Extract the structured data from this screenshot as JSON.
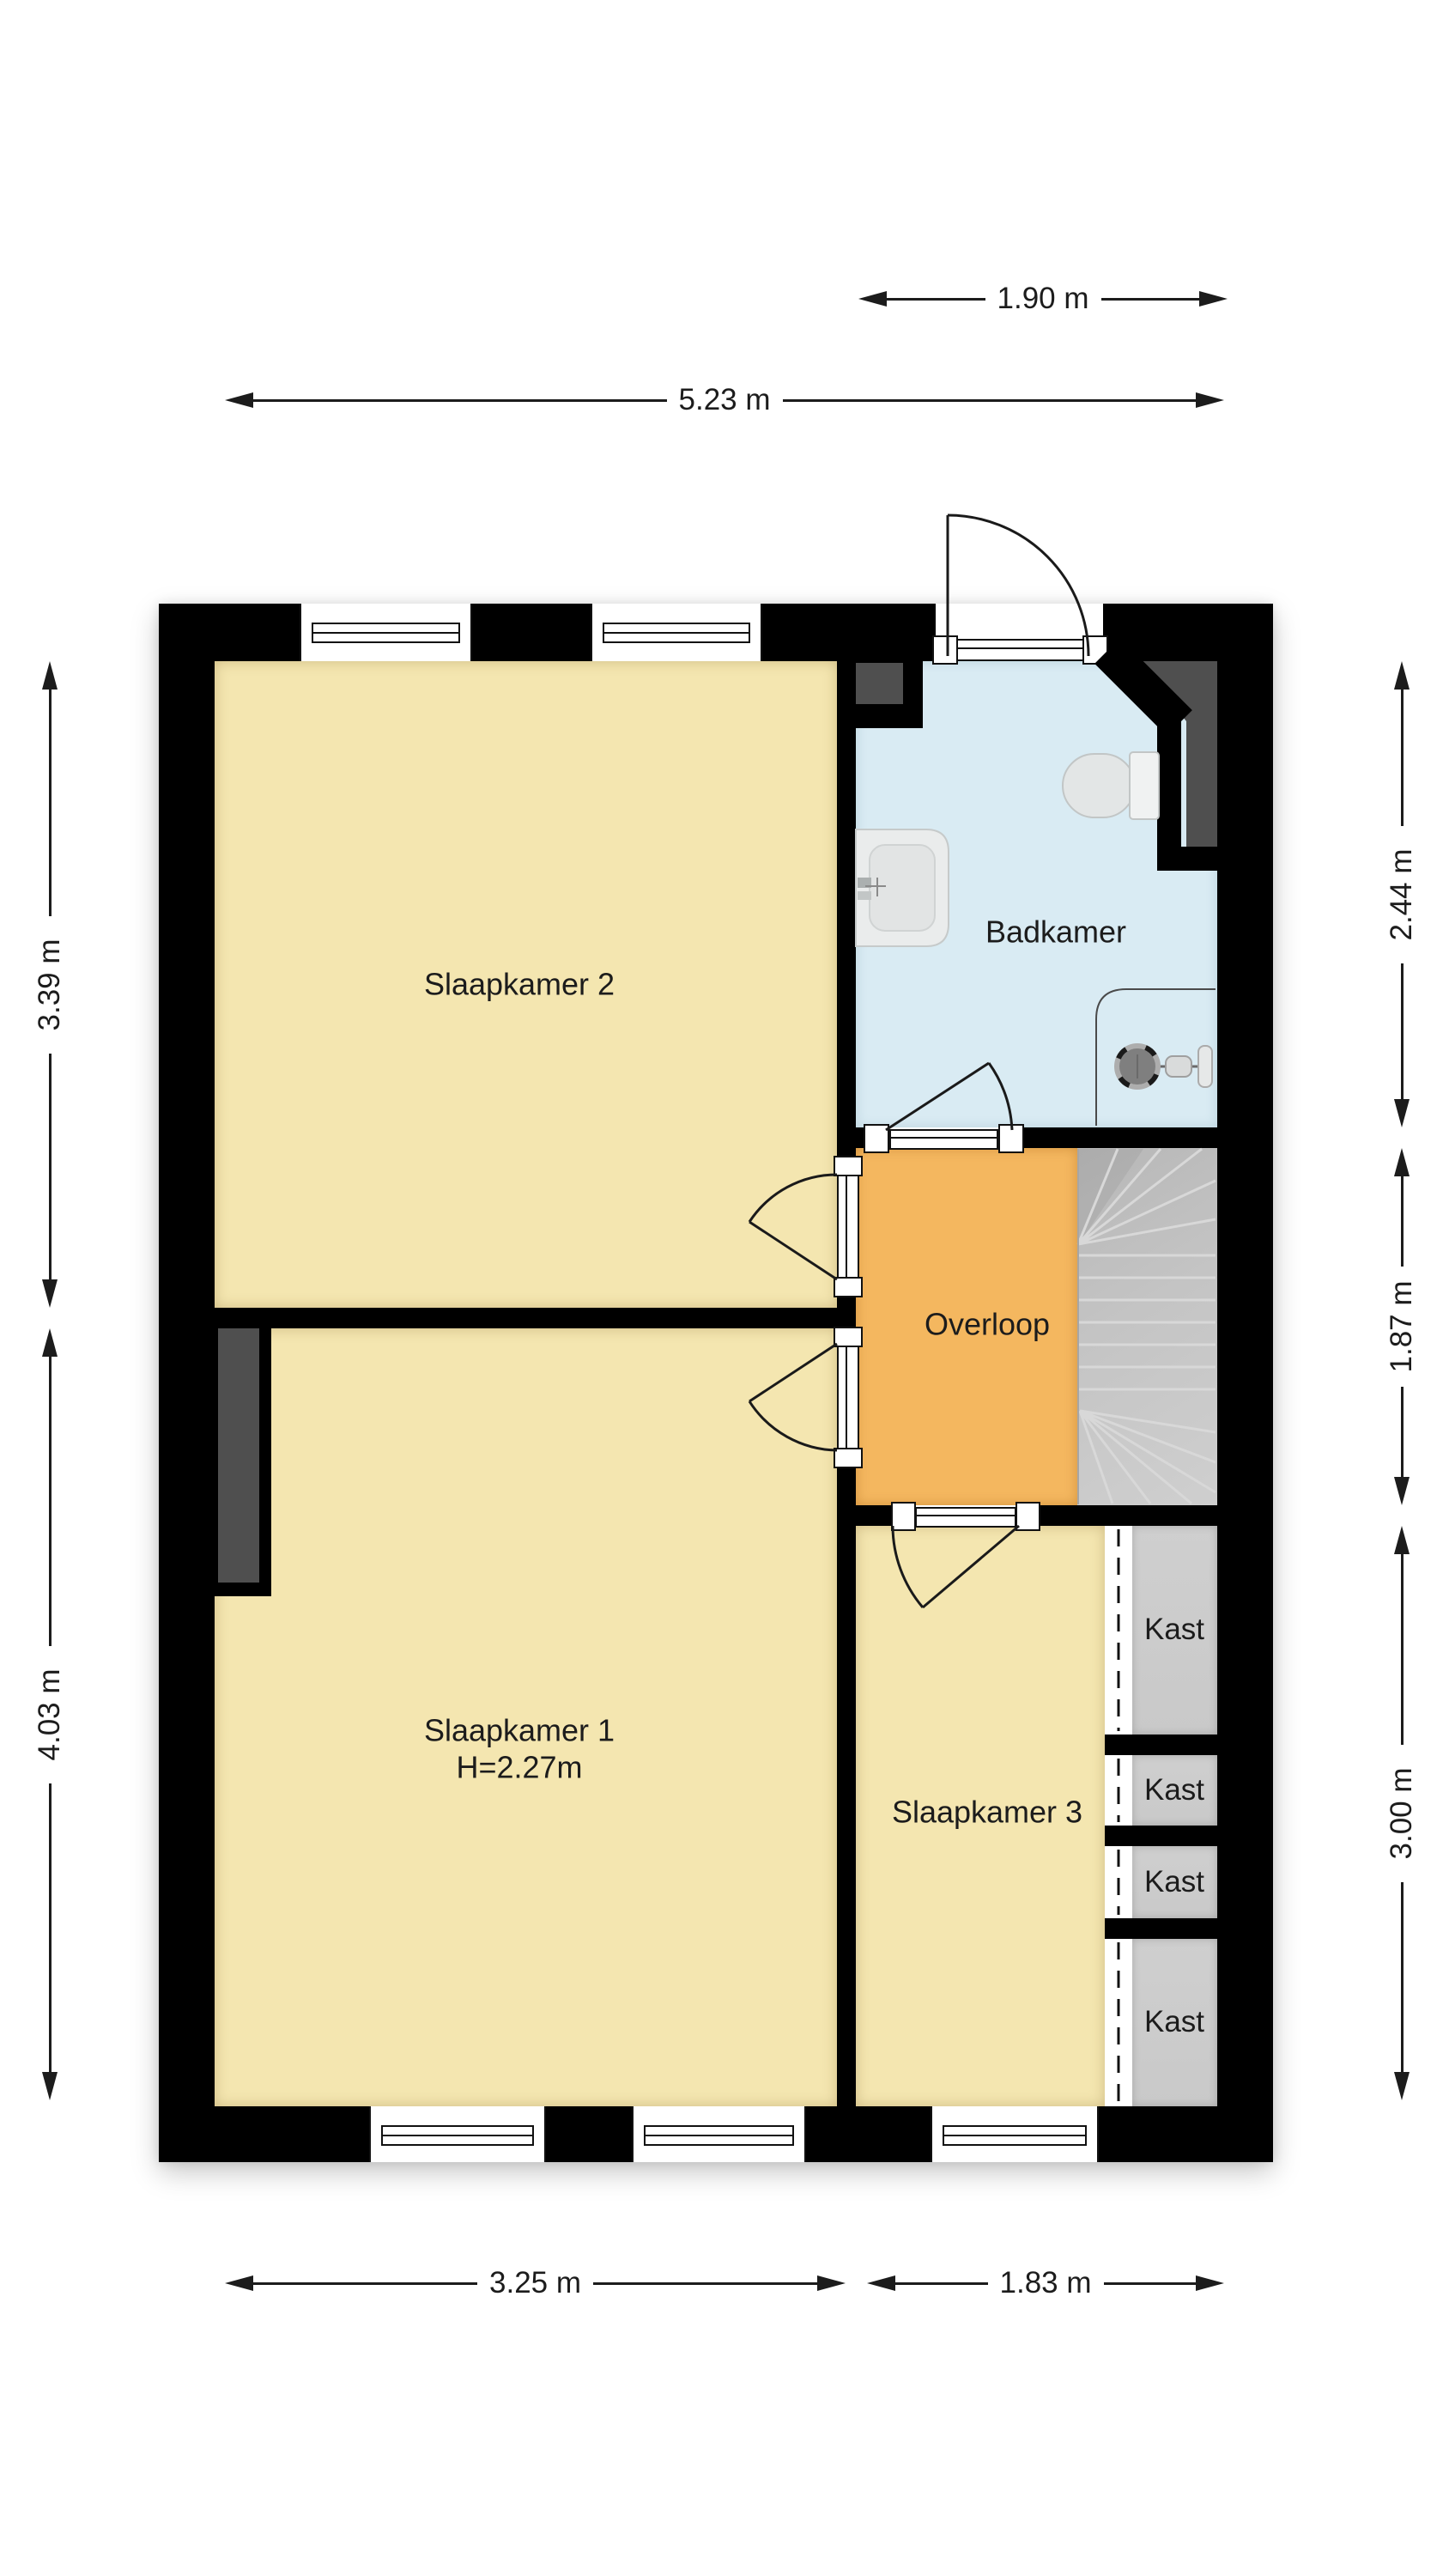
{
  "plan": {
    "rooms": {
      "slaapkamer2": {
        "label": "Slaapkamer 2"
      },
      "slaapkamer1": {
        "label": "Slaapkamer 1",
        "height_note": "H=2.27m"
      },
      "slaapkamer3": {
        "label": "Slaapkamer 3"
      },
      "badkamer": {
        "label": "Badkamer"
      },
      "overloop": {
        "label": "Overloop"
      },
      "closet": {
        "label": "Kast",
        "count": 4
      }
    },
    "dimensions": {
      "top_section": "1.90 m",
      "top_total": "5.23 m",
      "left_upper": "3.39 m",
      "left_lower": "4.03 m",
      "right_upper": "2.44 m",
      "right_middle": "1.87 m",
      "right_lower": "3.00 m",
      "bottom_left": "3.25 m",
      "bottom_right": "1.83 m"
    },
    "colors": {
      "wall": "#000000",
      "bedroom_floor": "#F4E6B0",
      "bathroom_floor": "#D9EBF3",
      "hallway_floor": "#F4B75F",
      "closet_floor": "#C9C9C9",
      "stairs_floor": "#C4C4C4",
      "duct": "#4F4F4F",
      "text": "#1C1C1C"
    }
  }
}
